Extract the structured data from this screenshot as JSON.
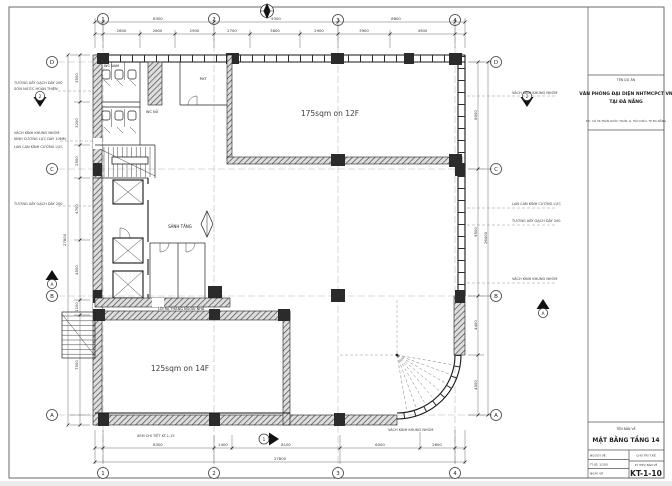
{
  "colors": {
    "paper": "#ffffff",
    "ink": "#1c1c1c"
  },
  "plan": {
    "grid": {
      "cols": [
        "1",
        "2",
        "3",
        "4"
      ],
      "rows": [
        "D",
        "C",
        "B",
        "A"
      ]
    },
    "areas": {
      "upper": "175sqm on 12F",
      "lower": "125sqm on 14F"
    },
    "rooms": {
      "wc_nam": "WC NAM",
      "wc_nu": "WC NỮ",
      "lobby": "SẢNH TẦNG",
      "tech": "P.KT",
      "exit_note": "LỐI RA THANG NGOÀI NHÀ"
    },
    "markers": {
      "left_top": "2",
      "right_top": "2",
      "right_bottom": "A",
      "left_mid": "A",
      "bottom": "1"
    },
    "dims": {
      "top_bays": [
        "8300",
        "9300",
        "8800"
      ],
      "top_detail": [
        "2800",
        "2600",
        "2900",
        "2700",
        "3800",
        "2900",
        "3900",
        "4900"
      ],
      "bottom_detail": [
        "8300",
        "1400",
        "8100",
        "6000",
        "2600"
      ],
      "bottom_total": "27800",
      "left_detail": [
        "3500",
        "3200",
        "2500",
        "4700",
        "4500",
        "1100",
        "7500"
      ],
      "left_total": "27800",
      "right_detail": [
        "8000",
        "9500",
        "4400",
        "4500"
      ],
      "right_total": "26400"
    },
    "notes": {
      "l1a": "TƯỜNG XÂY GẠCH DÀY 200",
      "l1b": "SƠN NƯỚC HOÀN THIỆN",
      "l2a": "VÁCH KÍNH KHUNG NHÔM",
      "l2b": "KÍNH CƯỜNG LỰC DÀY 10MM",
      "l3": "LAN CAN KÍNH CƯỜNG LỰC",
      "l4": "TƯỜNG XÂY GẠCH DÀY 200",
      "r1": "VÁCH KÍNH KHUNG NHÔM",
      "r2": "LAN CAN KÍNH CƯỜNG LỰC",
      "r3": "TƯỜNG XÂY GẠCH DÀY 200",
      "r4": "VÁCH KÍNH KHUNG NHÔM",
      "b1": "XEM CHI TIẾT KT-1-15",
      "b2": "VÁCH KÍNH KHUNG NHÔM"
    }
  },
  "title_block": {
    "project_label": "TÊN DỰ ÁN",
    "project_name_1": "VĂN PHÒNG ĐẠI DIỆN NHTMCPCT VN",
    "project_name_2": "TẠI ĐÀ NẴNG",
    "project_address": "ĐC: SỐ 36 TRẦN QUỐC TOẢN, Q. HẢI CHÂU, TP ĐÀ NẴNG",
    "drawing_label": "TÊN BẢN VẼ",
    "drawing_title": "MẶT BẰNG TẦNG 14",
    "row1_left": "NGƯỜI VẼ",
    "row2_left": "TỈ LỆ: 1/100",
    "row3_left": "NGÀY VẼ",
    "row1_right": "CHỦ TRÌ T.KẾ",
    "code_label": "KÝ HIỆU BẢN VẼ",
    "drawing_number": "KT-1-10"
  }
}
